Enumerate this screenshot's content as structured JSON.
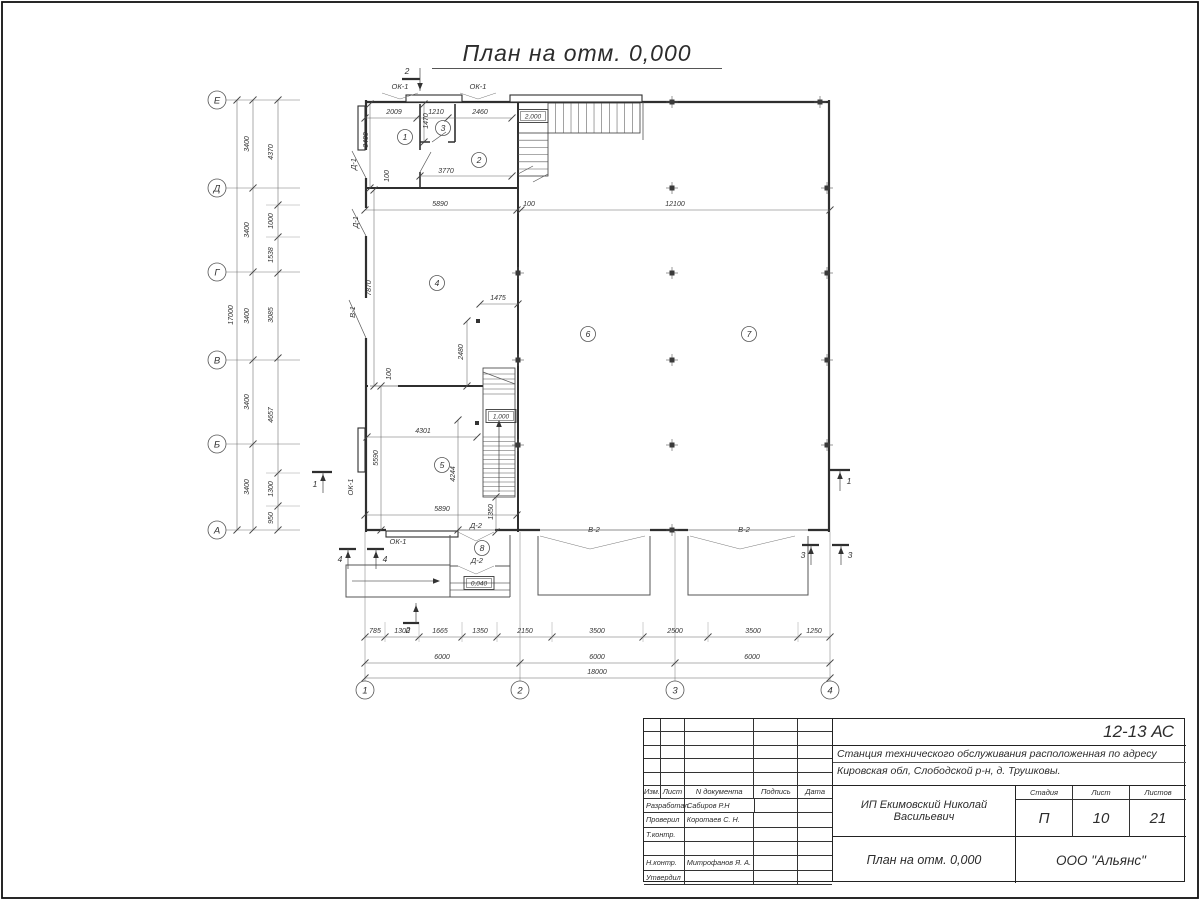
{
  "title": "План на отм. 0,000",
  "plan": {
    "axes_left": [
      {
        "t": "Е",
        "y": 100
      },
      {
        "t": "Д",
        "y": 188
      },
      {
        "t": "Г",
        "y": 272
      },
      {
        "t": "В",
        "y": 360
      },
      {
        "t": "Б",
        "y": 444
      },
      {
        "t": "А",
        "y": 530
      }
    ],
    "axes_bottom": [
      {
        "t": "1",
        "x": 365
      },
      {
        "t": "2",
        "x": 520
      },
      {
        "t": "3",
        "x": 675
      },
      {
        "t": "4",
        "x": 830
      }
    ],
    "dim_labels_h": [
      {
        "t": "2009",
        "x": 394,
        "y": 114
      },
      {
        "t": "1210",
        "x": 436,
        "y": 114
      },
      {
        "t": "2460",
        "x": 480,
        "y": 114
      },
      {
        "t": "3770",
        "x": 446,
        "y": 173
      },
      {
        "t": "5890",
        "x": 440,
        "y": 206
      },
      {
        "t": "100",
        "x": 529,
        "y": 206
      },
      {
        "t": "12100",
        "x": 675,
        "y": 206
      },
      {
        "t": "1475",
        "x": 498,
        "y": 300
      },
      {
        "t": "4301",
        "x": 423,
        "y": 433
      },
      {
        "t": "5890",
        "x": 442,
        "y": 511
      },
      {
        "t": "785",
        "x": 375,
        "y": 633
      },
      {
        "t": "1300",
        "x": 402,
        "y": 633
      },
      {
        "t": "1665",
        "x": 440,
        "y": 633
      },
      {
        "t": "1350",
        "x": 480,
        "y": 633
      },
      {
        "t": "2150",
        "x": 525,
        "y": 633
      },
      {
        "t": "3500",
        "x": 597,
        "y": 633
      },
      {
        "t": "2500",
        "x": 675,
        "y": 633
      },
      {
        "t": "3500",
        "x": 753,
        "y": 633
      },
      {
        "t": "1250",
        "x": 814,
        "y": 633
      },
      {
        "t": "6000",
        "x": 442,
        "y": 659
      },
      {
        "t": "6000",
        "x": 597,
        "y": 659
      },
      {
        "t": "6000",
        "x": 752,
        "y": 659
      },
      {
        "t": "18000",
        "x": 597,
        "y": 674
      }
    ],
    "dim_labels_v": [
      {
        "t": "3400",
        "x": 368,
        "y": 140
      },
      {
        "t": "1470",
        "x": 428,
        "y": 121
      },
      {
        "t": "100",
        "x": 389,
        "y": 176
      },
      {
        "t": "7870",
        "x": 371,
        "y": 288
      },
      {
        "t": "2480",
        "x": 463,
        "y": 352
      },
      {
        "t": "100",
        "x": 391,
        "y": 374
      },
      {
        "t": "5590",
        "x": 378,
        "y": 458
      },
      {
        "t": "4244",
        "x": 455,
        "y": 474
      },
      {
        "t": "1350",
        "x": 493,
        "y": 512
      },
      {
        "t": "17000",
        "x": 233,
        "y": 315
      },
      {
        "t": "3400",
        "x": 249,
        "y": 144
      },
      {
        "t": "3400",
        "x": 249,
        "y": 230
      },
      {
        "t": "3400",
        "x": 249,
        "y": 316
      },
      {
        "t": "3400",
        "x": 249,
        "y": 402
      },
      {
        "t": "3400",
        "x": 249,
        "y": 487
      },
      {
        "t": "4370",
        "x": 273,
        "y": 152
      },
      {
        "t": "1000",
        "x": 273,
        "y": 221
      },
      {
        "t": "1538",
        "x": 273,
        "y": 255
      },
      {
        "t": "3085",
        "x": 273,
        "y": 315
      },
      {
        "t": "4657",
        "x": 273,
        "y": 415
      },
      {
        "t": "1300",
        "x": 273,
        "y": 489
      },
      {
        "t": "950",
        "x": 273,
        "y": 518
      }
    ],
    "opening_labels": [
      {
        "t": "ОК-1",
        "x": 400,
        "y": 89,
        "r": 0
      },
      {
        "t": "ОК-1",
        "x": 478,
        "y": 89,
        "r": 0
      },
      {
        "t": "Д-1",
        "x": 356,
        "y": 164,
        "r": 1
      },
      {
        "t": "Д-1",
        "x": 358,
        "y": 222,
        "r": 1
      },
      {
        "t": "В-1",
        "x": 355,
        "y": 312,
        "r": 1
      },
      {
        "t": "ОК-1",
        "x": 353,
        "y": 487,
        "r": 1
      },
      {
        "t": "ОК-1",
        "x": 398,
        "y": 544,
        "r": 0
      },
      {
        "t": "Д-2",
        "x": 476,
        "y": 528,
        "r": 0
      },
      {
        "t": "Д-2",
        "x": 477,
        "y": 563,
        "r": 0
      },
      {
        "t": "В-2",
        "x": 594,
        "y": 532,
        "r": 0
      },
      {
        "t": "В-2",
        "x": 744,
        "y": 532,
        "r": 0
      }
    ],
    "levels": [
      {
        "t": "2,000",
        "x": 533,
        "y": 116
      },
      {
        "t": "1,000",
        "x": 501,
        "y": 416
      },
      {
        "t": "0,040",
        "x": 479,
        "y": 583
      }
    ],
    "rooms": [
      {
        "n": "1",
        "x": 405,
        "y": 137
      },
      {
        "n": "2",
        "x": 479,
        "y": 160
      },
      {
        "n": "3",
        "x": 443,
        "y": 128
      },
      {
        "n": "4",
        "x": 437,
        "y": 283
      },
      {
        "n": "5",
        "x": 442,
        "y": 465
      },
      {
        "n": "6",
        "x": 588,
        "y": 334
      },
      {
        "n": "7",
        "x": 749,
        "y": 334
      },
      {
        "n": "8",
        "x": 482,
        "y": 548
      }
    ],
    "section_marks": [
      {
        "t": "2",
        "x": 407,
        "y": 74
      },
      {
        "t": "2",
        "x": 408,
        "y": 633
      },
      {
        "t": "1",
        "x": 315,
        "y": 487
      },
      {
        "t": "1",
        "x": 849,
        "y": 484
      },
      {
        "t": "4",
        "x": 340,
        "y": 562
      },
      {
        "t": "4",
        "x": 385,
        "y": 562
      },
      {
        "t": "3",
        "x": 803,
        "y": 558
      },
      {
        "t": "3",
        "x": 850,
        "y": 558
      }
    ]
  },
  "title_block": {
    "doc_number": "12-13 АС",
    "project_line1": "Станция технического обслуживания расположенная по адресу",
    "project_line2": "Кировская обл, Слободской р-н, д. Трушковы.",
    "client": "ИП Екимовский Николай Васильевич",
    "sheet_title": "План на отм. 0,000",
    "organization": "ООО \"Альянс\"",
    "cols": {
      "izm": "Изм.",
      "list": "Лист",
      "ndoc": "N документа",
      "podpis": "Подпись",
      "data": "Дата"
    },
    "stage_label": "Стадия",
    "sheet_label": "Лист",
    "sheets_label": "Листов",
    "stage": "П",
    "sheet_no": "10",
    "sheets_total": "21",
    "roles": [
      {
        "role": "Разработал",
        "name": "Сабиров Р.Н"
      },
      {
        "role": "Проверил",
        "name": "Коротаев С. Н."
      },
      {
        "role": "Т.контр.",
        "name": ""
      },
      {
        "role": "",
        "name": ""
      },
      {
        "role": "Н.контр.",
        "name": "Митрофанов Я. А."
      },
      {
        "role": "Утвердил",
        "name": ""
      }
    ]
  }
}
